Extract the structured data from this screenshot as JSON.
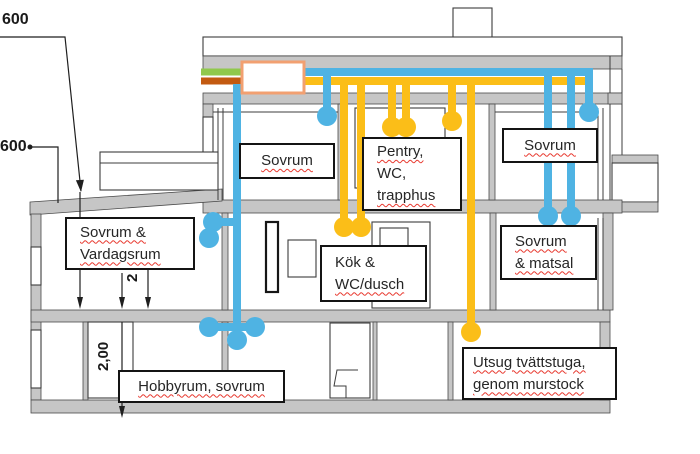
{
  "colors": {
    "supply_air_blue": "#4FB3E3",
    "extract_air_yellow": "#FBBE18",
    "outdoor_air_green": "#90C84C",
    "exhaust_air_orange": "#C35A11",
    "unit_border_orange": "#F2A071",
    "wall_gray": "#C6C6C6",
    "label_border": "#141414",
    "spellcheck_red": "#E8392F",
    "text_dark": "#262626"
  },
  "rooms": {
    "sovrum_upper_left": {
      "label": "Sovrum"
    },
    "pentry_wc_trapphus": {
      "line1": "Pentry,",
      "line2": "WC,",
      "line3": "trapphus"
    },
    "sovrum_upper_right": {
      "label": "Sovrum"
    },
    "sovrum_vardagsrum": {
      "line1": "Sovrum &",
      "line2": "Vardagsrum"
    },
    "kok_wc_dusch": {
      "line1": "Kök &",
      "line2": "WC/dusch"
    },
    "sovrum_matsal": {
      "line1": "Sovrum",
      "line2": "& matsal"
    },
    "hobbyrum_sovrum": {
      "label": "Hobbyrum, sovrum"
    },
    "utsug_tvattstuga": {
      "line1": "Utsug tvättstuga,",
      "line2": "genom murstock"
    }
  },
  "dimensions": {
    "roof_offset_top": "600",
    "roof_offset_left": "600",
    "floor2_height_partial": "2",
    "floor1_height": "2,00"
  }
}
